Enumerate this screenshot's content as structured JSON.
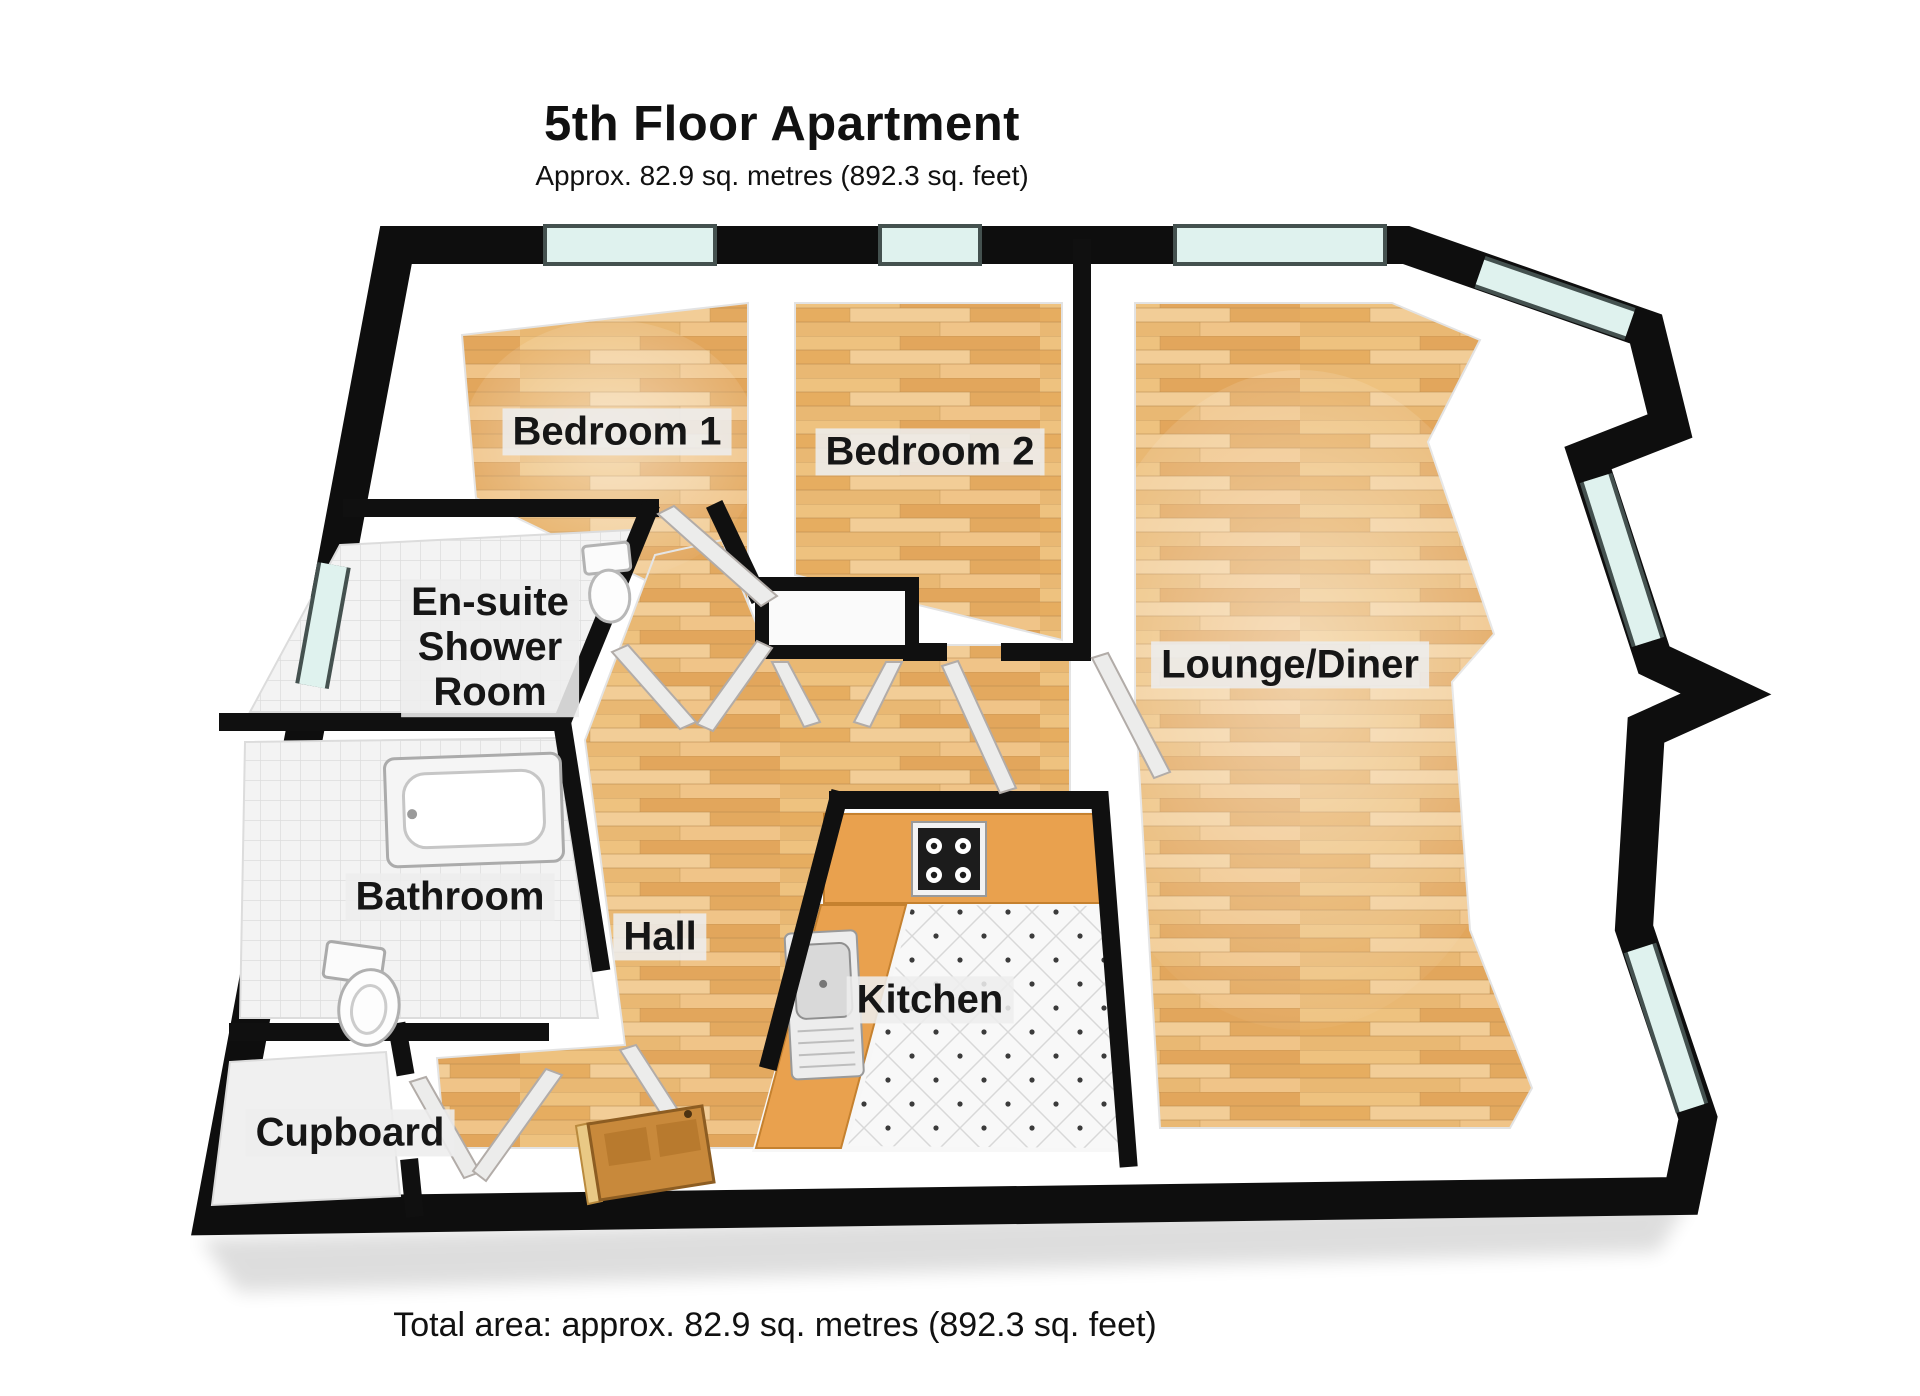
{
  "header": {
    "title": "5th Floor Apartment",
    "subtitle": "Approx. 82.9 sq. metres (892.3 sq. feet)"
  },
  "footer": {
    "total_area": "Total area: approx. 82.9 sq. metres (892.3 sq. feet)"
  },
  "rooms": [
    {
      "id": "bedroom-1",
      "label": "Bedroom 1"
    },
    {
      "id": "bedroom-2",
      "label": "Bedroom 2"
    },
    {
      "id": "en-suite-shower-room",
      "label": "En-suite\nShower\nRoom"
    },
    {
      "id": "lounge-diner",
      "label": "Lounge/Diner"
    },
    {
      "id": "bathroom",
      "label": "Bathroom"
    },
    {
      "id": "hall",
      "label": "Hall"
    },
    {
      "id": "kitchen",
      "label": "Kitchen"
    },
    {
      "id": "cupboard",
      "label": "Cupboard"
    }
  ],
  "colors": {
    "wall": "#0e0e0e",
    "wood_light": "#f0cd96",
    "wood_mid": "#e3ae66",
    "window_glass": "#dff2ee",
    "tile_floor": "#f3f3f3",
    "kitchen_counter": "#e9a14e",
    "entrance_door_wood": "#c8893b",
    "label_background": "#ededed",
    "text": "#161616"
  }
}
